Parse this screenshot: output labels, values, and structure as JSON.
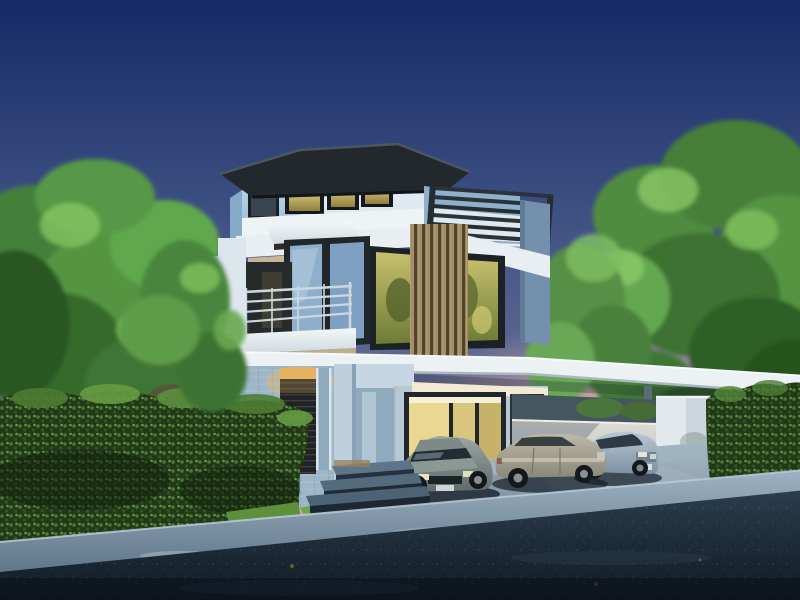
{
  "scene": {
    "type": "3d-architectural-rendering",
    "subject": "modern three-storey detached house at dusk",
    "time_of_day": "dusk",
    "setting": "residential street with driveway and carport",
    "house": {
      "floors": 3,
      "features": [
        "flat charcoal overhanging roof",
        "light-blue and white walls",
        "warm lit penthouse window band",
        "steel pergola over roof terrace",
        "glass balustrade",
        "vertical timber louver screen",
        "steel balcony railing",
        "corner glass window reflecting sky",
        "warm green-gold glazing",
        "slatted entry door with lit transom",
        "entry portal frame with steps",
        "carport with flat white roof",
        "lit ground-floor window under carport"
      ]
    },
    "vehicles": {
      "count": 3,
      "types": [
        "grey-green sedan",
        "silver-tan sedan",
        "light-blue sedan"
      ]
    },
    "vegetation": [
      "left birch trees",
      "right broadleaf tree",
      "center tree behind carport",
      "dense left hedge",
      "right hedge"
    ],
    "ground": [
      "light concrete driveway apron",
      "light-blue curb band",
      "dark asphalt road",
      "small grass patch",
      "dark stone steps"
    ],
    "boundary": [
      "white fence wall behind cars",
      "white gate pillar"
    ]
  },
  "palette": {
    "sky_top": "#152a66",
    "sky_mid": "#3c4f82",
    "sky_low": "#7e7899",
    "horizon_pink": "#c9a09b",
    "glow_warm": "#e9b7a3",
    "foliage_dark": "#2f5f28",
    "foliage_mid": "#4f8c3f",
    "foliage_light": "#6fb558",
    "foliage_highlight": "#8ac866",
    "hedge_base": "#22381a",
    "hedge_lit": "#5d8f3e",
    "trunk_birch": "#cfd8d2",
    "trunk_dark": "#3b332b",
    "roof_charcoal": "#22282c",
    "roof_edge": "#4a575e",
    "wall_blue_light": "#bcd7ea",
    "wall_blue": "#8fb3d2",
    "wall_white": "#eef3f6",
    "wall_shade": "#7ea3c4",
    "panel_bluegray": "#7490ac",
    "glass_warm_hi": "#e9d685",
    "glass_warm_lo": "#8f7f3e",
    "glass_green_hi": "#c6c06c",
    "glass_green_lo": "#6d7c36",
    "glass_sky": "#8fb0cc",
    "frame_dark": "#1b2024",
    "wood_slat": "#c2a97a",
    "wood_gap": "#5b4c36",
    "pergola_steel": "#2c3337",
    "railing_steel": "#cdd7de",
    "door_dark": "#1e2327",
    "transom_glow": "#e7b25f",
    "ceiling_glow": "#f2ead2",
    "window_glow": "#ead792",
    "fence_top": "#e0ddd4",
    "fence_bottom": "#b4bcc2",
    "pillar_light": "#e2e8ec",
    "pillar_mid": "#cdd6dc",
    "column_gray": "#5a6b79",
    "apron_hi": "#a9bac6",
    "apron_lo": "#74899b",
    "curb_hi": "#9db2c2",
    "curb_lo": "#5f7689",
    "road_hi": "#2a3d4e",
    "road_lo": "#101922",
    "grass": "#5d8f3d",
    "car_left_hi": "#9aa6a2",
    "car_left_lo": "#5f6b68",
    "car_middle_hi": "#bdb8a8",
    "car_middle_lo": "#8a8878",
    "car_right_hi": "#b9c9d6",
    "car_right_lo": "#7d90a1",
    "shadow": "#101a24"
  }
}
